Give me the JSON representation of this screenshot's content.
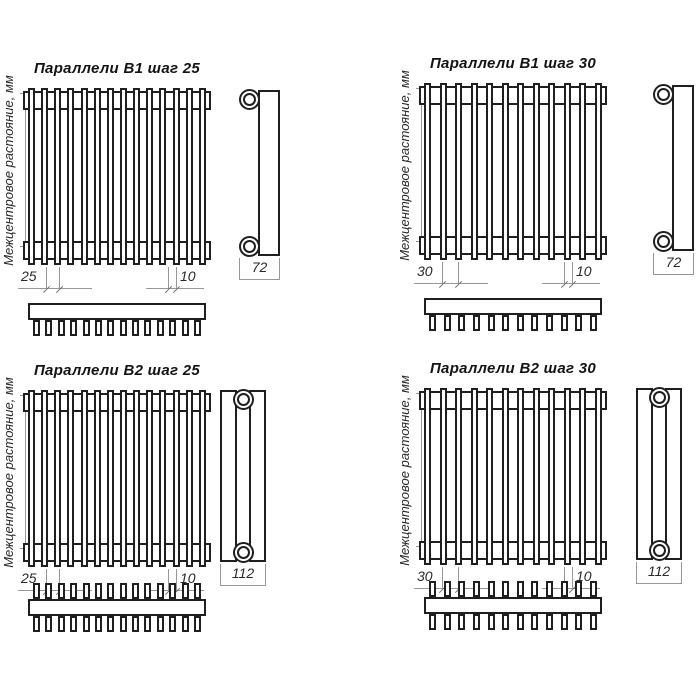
{
  "drawing": {
    "axis_label": "Межцентровое растояние, мм",
    "colors": {
      "outline": "#1f1f1f",
      "dimension_lines": "#979797",
      "background": "#ffffff",
      "text": "#2a2a2a"
    },
    "diagrams": [
      {
        "title": "Параллели В1 шаг 25",
        "pitch": "25",
        "tube_width": "10",
        "depth": "72",
        "tubes": 14,
        "rows": 1
      },
      {
        "title": "Параллели В1 шаг 30",
        "pitch": "30",
        "tube_width": "10",
        "depth": "72",
        "tubes": 12,
        "rows": 1
      },
      {
        "title": "Параллели В2 шаг 25",
        "pitch": "25",
        "tube_width": "10",
        "depth": "112",
        "tubes": 14,
        "rows": 2
      },
      {
        "title": "Параллели В2 шаг 30",
        "pitch": "30",
        "tube_width": "10",
        "depth": "112",
        "tubes": 12,
        "rows": 2
      }
    ]
  }
}
